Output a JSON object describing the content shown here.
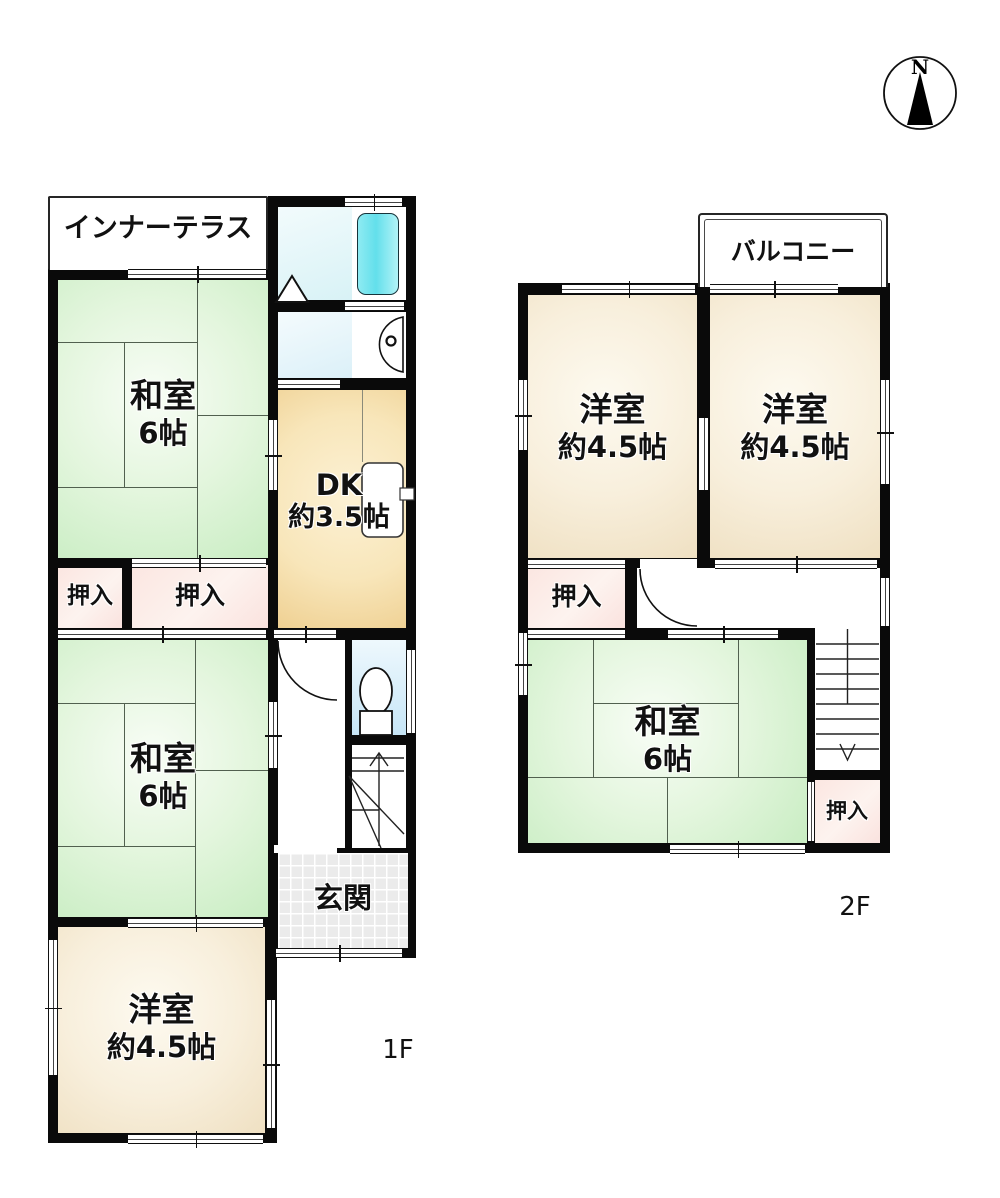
{
  "compass": {
    "label": "N"
  },
  "floor1": {
    "floor_label": "1F",
    "rooms": {
      "inner_terrace": {
        "label": "インナーテラス"
      },
      "washitsu_top": {
        "label": "和室",
        "size": "6帖"
      },
      "dk": {
        "label": "DK",
        "size": "約3.5帖"
      },
      "oshiire_left": {
        "label": "押入"
      },
      "oshiire_right": {
        "label": "押入"
      },
      "washitsu_bottom": {
        "label": "和室",
        "size": "6帖"
      },
      "genkan": {
        "label": "玄関"
      },
      "youshitsu": {
        "label": "洋室",
        "size": "約4.5帖"
      }
    }
  },
  "floor2": {
    "floor_label": "2F",
    "rooms": {
      "balcony": {
        "label": "バルコニー"
      },
      "youshitsu_left": {
        "label": "洋室",
        "size": "約4.5帖"
      },
      "youshitsu_right": {
        "label": "洋室",
        "size": "約4.5帖"
      },
      "oshiire_top": {
        "label": "押入"
      },
      "washitsu": {
        "label": "和室",
        "size": "6帖"
      },
      "oshiire_bottom": {
        "label": "押入"
      }
    }
  },
  "colors": {
    "wall": "#0a0a0a",
    "tatami_room": "#dff4da",
    "western_room": "#f8efdc",
    "dk_room": "#f6e3b4",
    "closet_pink": "#fbe7e3",
    "bathtub_cyan": "#76e4ee",
    "bath_floor": "#e2f4f7",
    "toilet_floor": "#d5eaf8",
    "genkan_tile": "#ebebeb"
  }
}
